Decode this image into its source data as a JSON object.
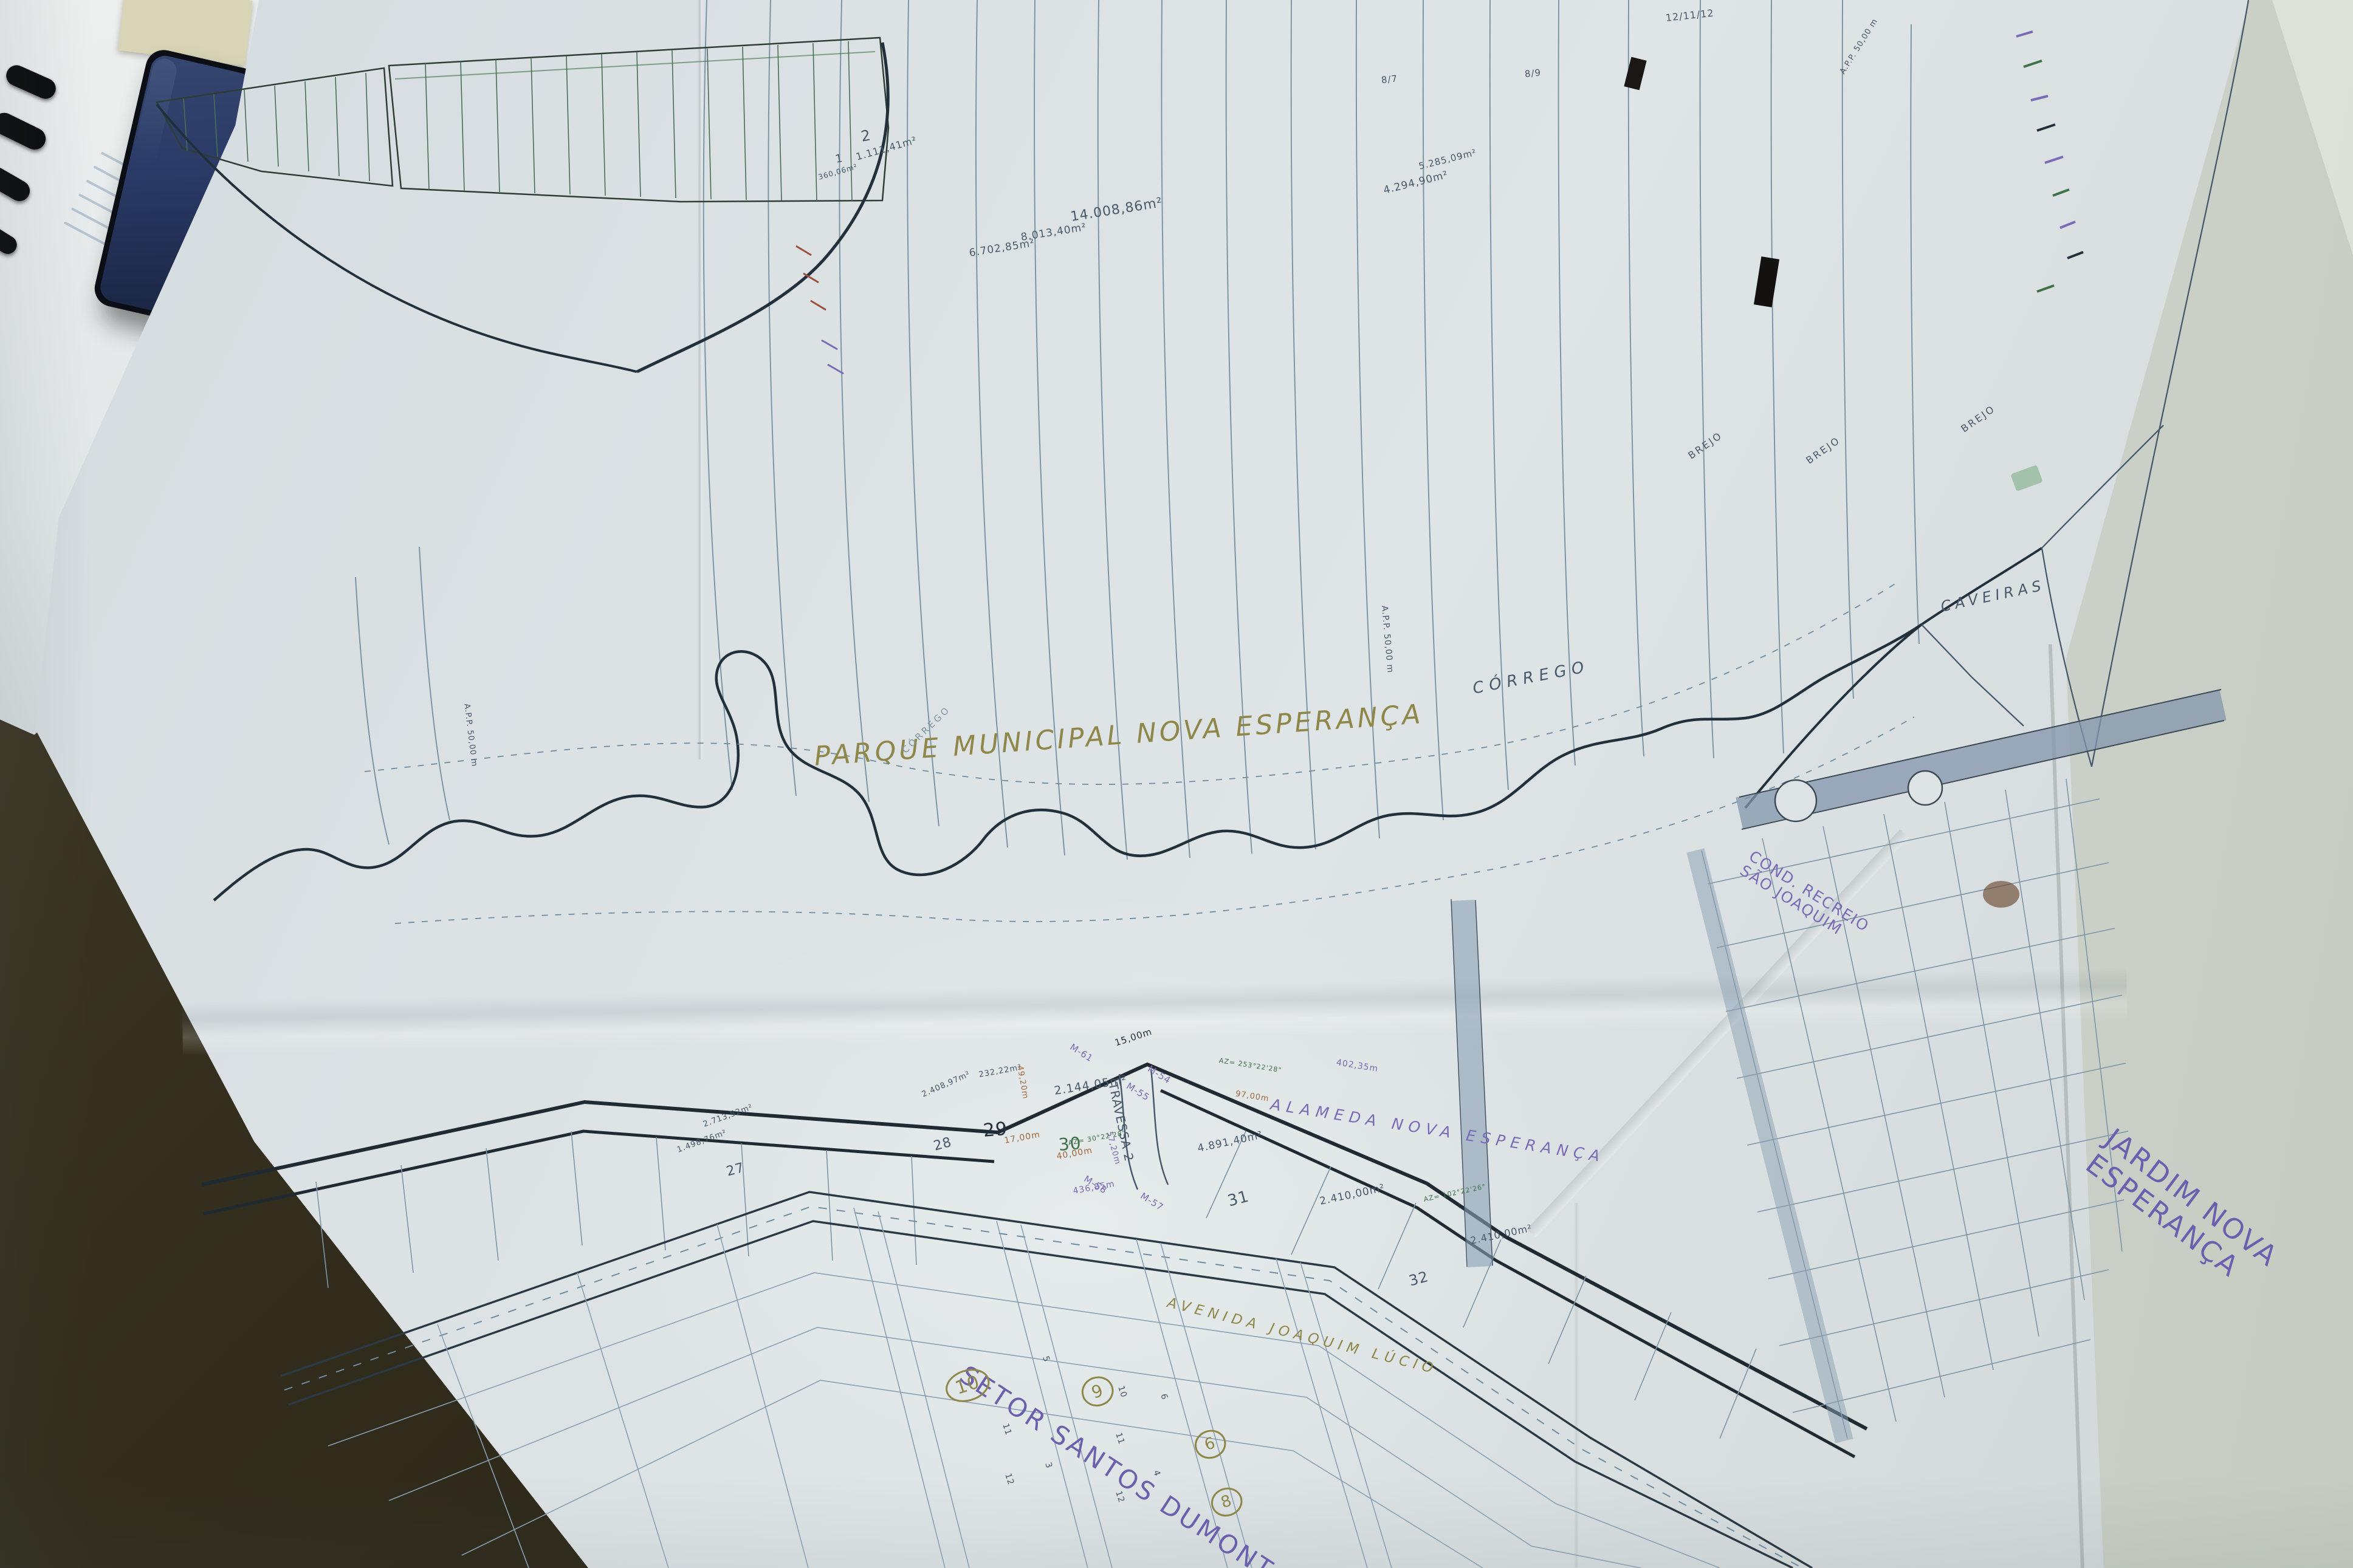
{
  "scene": {
    "type": "photograph of a folded cadastral street map lying on a desk",
    "objects": [
      "smartphone",
      "binder-rings",
      "cream-folder",
      "document-stack",
      "map-sheet",
      "folded-companion-sheet",
      "desk-surface",
      "black-tape-marks"
    ]
  },
  "palette": {
    "ink": "#47596b",
    "inkDark": "#22303c",
    "inkLight": "#7e95a6",
    "green": "#3f7249",
    "purple": "#7b6ab8",
    "violet": "#6c5fae",
    "olive": "#8f874a",
    "orange": "#a06a3c",
    "blueRoad": "#8296ac",
    "phoneScreen": "#2a3a66",
    "paper": "#dce2e4",
    "desk": "#332e1d"
  },
  "map": {
    "park_title": "PARQUE MUNICIPAL NOVA ESPERANÇA",
    "sector_title": "SETOR SANTOS DUMONT",
    "adjacent_panel_title": "JARDIM NOVA ESPERANÇA",
    "watercourse": [
      "CÓRREGO",
      "CAVEIRAS"
    ],
    "streets": [
      "ALAMEDA NOVA ESPERANÇA",
      "AVENIDA JOAQUIM LÚCIO",
      "TRAVESSA 2"
    ],
    "condominium": "COND. RECREIO SÃO JOAQUIM",
    "protection_strip": "A.P.P. 50,00 m",
    "wetland": "BREJO",
    "labels": [
      {
        "name": "park-title",
        "text": "PARQUE MUNICIPAL NOVA ESPERANÇA",
        "x": 34.6,
        "y": 47.3,
        "rot": -4,
        "size": 44,
        "color": "olive",
        "spacing": 5,
        "italic": true
      },
      {
        "name": "sector-title",
        "text": "SETOR SANTOS DUMONT",
        "x": 40.9,
        "y": 86.6,
        "rot": 33,
        "size": 42,
        "color": "violet",
        "spacing": 4
      },
      {
        "name": "jardim-panel-title",
        "text": "JARDIM NOVA\nESPERANÇA",
        "x": 89.2,
        "y": 71.2,
        "rot": 37,
        "size": 46,
        "color": "violet",
        "spacing": 3
      },
      {
        "name": "corrego-label",
        "text": "CÓRREGO",
        "x": 62.6,
        "y": 43.4,
        "rot": -11,
        "size": 26,
        "color": "ink",
        "spacing": 9,
        "italic": true
      },
      {
        "name": "caveiras-label",
        "text": "CAVEIRAS",
        "x": 82.5,
        "y": 38.2,
        "rot": -12,
        "size": 24,
        "color": "ink",
        "spacing": 7,
        "italic": true
      },
      {
        "name": "corrego-small-label",
        "text": "CÓRREGO",
        "x": 38.4,
        "y": 47.6,
        "rot": -44,
        "size": 15,
        "color": "inkLight",
        "spacing": 4
      },
      {
        "name": "cond-recreio-label",
        "text": "COND. RECREIO\nSÃO JOAQUIM",
        "x": 74.2,
        "y": 53.9,
        "rot": 32,
        "size": 25,
        "color": "purple",
        "spacing": 2
      },
      {
        "name": "alameda-label",
        "text": "ALAMEDA  NOVA  ESPERANÇA",
        "x": 54.0,
        "y": 69.9,
        "rot": 9,
        "size": 25,
        "color": "purple",
        "spacing": 9,
        "italic": true
      },
      {
        "name": "avenida-label",
        "text": "AVENIDA  JOAQUIM  LÚCIO",
        "x": 49.6,
        "y": 82.6,
        "rot": 14,
        "size": 23,
        "color": "olive",
        "spacing": 8,
        "italic": true
      },
      {
        "name": "travessa-label",
        "text": "TRAVESSA 2",
        "x": 47.3,
        "y": 68.6,
        "rot": 78,
        "size": 20,
        "color": "ink"
      },
      {
        "name": "brejo-label-1",
        "text": "BREJO",
        "x": 71.8,
        "y": 28.8,
        "rot": -35,
        "size": 16,
        "color": "ink",
        "spacing": 3
      },
      {
        "name": "brejo-label-2",
        "text": "BREJO",
        "x": 76.8,
        "y": 29.1,
        "rot": -35,
        "size": 16,
        "color": "ink",
        "spacing": 3
      },
      {
        "name": "brejo-label-3",
        "text": "BREJO",
        "x": 83.4,
        "y": 27.1,
        "rot": -35,
        "size": 16,
        "color": "ink",
        "spacing": 3
      },
      {
        "name": "app-label-1",
        "text": "A.P.P. 50,00 m",
        "x": 19.8,
        "y": 44.6,
        "rot": 83,
        "size": 13,
        "color": "ink"
      },
      {
        "name": "app-label-2",
        "text": "A.P.P. 50,00 m",
        "x": 58.8,
        "y": 38.3,
        "rot": 85,
        "size": 14,
        "color": "ink"
      },
      {
        "name": "app-label-3",
        "text": "A.P.P. 50,00 m",
        "x": 78.3,
        "y": 4.4,
        "rot": -58,
        "size": 13,
        "color": "ink"
      },
      {
        "name": "area-14008",
        "text": "14.008,86m²",
        "x": 45.5,
        "y": 13.4,
        "rot": -9,
        "size": 22,
        "color": "ink"
      },
      {
        "name": "area-8013",
        "text": "8.013,40m²",
        "x": 43.4,
        "y": 14.8,
        "rot": -9,
        "size": 17,
        "color": "ink"
      },
      {
        "name": "area-6702",
        "text": "6.702,85m²",
        "x": 41.2,
        "y": 15.8,
        "rot": -9,
        "size": 17,
        "color": "ink"
      },
      {
        "name": "area-4294",
        "text": "4.294,90m²",
        "x": 58.8,
        "y": 11.8,
        "rot": -14,
        "size": 17,
        "color": "ink"
      },
      {
        "name": "area-5285",
        "text": "5.285,09m²",
        "x": 60.3,
        "y": 10.3,
        "rot": -14,
        "size": 15,
        "color": "ink"
      },
      {
        "name": "area-1111",
        "text": "1.111,41m²",
        "x": 36.4,
        "y": 9.7,
        "rot": -16,
        "size": 16,
        "color": "ink"
      },
      {
        "name": "area-360",
        "text": "360,06m²",
        "x": 34.8,
        "y": 11.1,
        "rot": -16,
        "size": 12,
        "color": "ink"
      },
      {
        "name": "area-2144",
        "text": "2.144,05m²",
        "x": 44.8,
        "y": 69.2,
        "rot": -9,
        "size": 19,
        "color": "ink"
      },
      {
        "name": "area-4891",
        "text": "4.891,40m²",
        "x": 50.9,
        "y": 72.9,
        "rot": -12,
        "size": 17,
        "color": "ink"
      },
      {
        "name": "area-2410-a",
        "text": "2.410,00m²",
        "x": 56.1,
        "y": 76.3,
        "rot": -12,
        "size": 17,
        "color": "ink"
      },
      {
        "name": "area-2410-b",
        "text": "2.410,00m²",
        "x": 62.5,
        "y": 78.8,
        "rot": -12,
        "size": 16,
        "color": "ink"
      },
      {
        "name": "area-232",
        "text": "232,22m²",
        "x": 41.6,
        "y": 68.3,
        "rot": -10,
        "size": 13,
        "color": "ink"
      },
      {
        "name": "area-2408",
        "text": "2.408,97m²",
        "x": 39.2,
        "y": 69.6,
        "rot": -24,
        "size": 13,
        "color": "ink"
      },
      {
        "name": "area-1498",
        "text": "1.498,76m²",
        "x": 28.8,
        "y": 73.1,
        "rot": -20,
        "size": 13,
        "color": "ink"
      },
      {
        "name": "area-2713",
        "text": "2.713,52m²",
        "x": 29.9,
        "y": 71.5,
        "rot": -20,
        "size": 13,
        "color": "ink"
      },
      {
        "name": "quadra-29",
        "text": "29",
        "x": 41.8,
        "y": 71.5,
        "rot": -5,
        "size": 30,
        "color": "inkDark"
      },
      {
        "name": "quadra-30",
        "text": "30",
        "x": 45.0,
        "y": 72.4,
        "rot": -5,
        "size": 28,
        "color": "green"
      },
      {
        "name": "quadra-28",
        "text": "28",
        "x": 39.7,
        "y": 72.7,
        "rot": -15,
        "size": 22,
        "color": "ink"
      },
      {
        "name": "quadra-31",
        "text": "31",
        "x": 52.2,
        "y": 76.1,
        "rot": -15,
        "size": 26,
        "color": "ink"
      },
      {
        "name": "quadra-32",
        "text": "32",
        "x": 59.9,
        "y": 81.2,
        "rot": -15,
        "size": 24,
        "color": "ink"
      },
      {
        "name": "quadra-27",
        "text": "27",
        "x": 30.9,
        "y": 74.3,
        "rot": -15,
        "size": 22,
        "color": "ink"
      },
      {
        "name": "quadra-2",
        "text": "2",
        "x": 36.6,
        "y": 8.2,
        "rot": -10,
        "size": 24,
        "color": "ink"
      },
      {
        "name": "quadra-1",
        "text": "1",
        "x": 35.5,
        "y": 9.8,
        "rot": -10,
        "size": 18,
        "color": "ink"
      },
      {
        "name": "circle-block-10",
        "text": "10",
        "x": 40.2,
        "y": 87.8,
        "rot": -18,
        "size": 30,
        "color": "olive",
        "circled": true
      },
      {
        "name": "circle-block-9",
        "text": "9",
        "x": 46.0,
        "y": 88.1,
        "rot": -18,
        "size": 28,
        "color": "olive",
        "circled": true
      },
      {
        "name": "circle-block-6",
        "text": "6",
        "x": 50.8,
        "y": 91.5,
        "rot": -18,
        "size": 26,
        "color": "olive",
        "circled": true
      },
      {
        "name": "circle-block-8",
        "text": "8",
        "x": 51.5,
        "y": 95.2,
        "rot": -18,
        "size": 26,
        "color": "olive",
        "circled": true
      },
      {
        "name": "lot-5",
        "text": "5",
        "x": 44.4,
        "y": 86.2,
        "rot": 72,
        "size": 14,
        "color": "ink"
      },
      {
        "name": "lot-10",
        "text": "10",
        "x": 47.6,
        "y": 88.1,
        "rot": 72,
        "size": 14,
        "color": "ink"
      },
      {
        "name": "lot-11a",
        "text": "11",
        "x": 47.5,
        "y": 91.1,
        "rot": 72,
        "size": 14,
        "color": "ink"
      },
      {
        "name": "lot-12a",
        "text": "12",
        "x": 47.5,
        "y": 94.8,
        "rot": 72,
        "size": 14,
        "color": "ink"
      },
      {
        "name": "lot-11b",
        "text": "11",
        "x": 42.7,
        "y": 90.5,
        "rot": 72,
        "size": 14,
        "color": "ink"
      },
      {
        "name": "lot-12b",
        "text": "12",
        "x": 42.8,
        "y": 93.7,
        "rot": 72,
        "size": 14,
        "color": "ink"
      },
      {
        "name": "lot-3",
        "text": "3",
        "x": 44.5,
        "y": 93.0,
        "rot": 72,
        "size": 14,
        "color": "ink"
      },
      {
        "name": "lot-6",
        "text": "6",
        "x": 49.4,
        "y": 88.6,
        "rot": 72,
        "size": 14,
        "color": "ink"
      },
      {
        "name": "lot-4",
        "text": "4",
        "x": 49.1,
        "y": 93.5,
        "rot": 72,
        "size": 14,
        "color": "ink"
      },
      {
        "name": "marker-m54",
        "text": "M-54",
        "x": 48.8,
        "y": 67.8,
        "rot": 32,
        "size": 15,
        "color": "purple"
      },
      {
        "name": "marker-m55",
        "text": "M-55",
        "x": 47.9,
        "y": 68.9,
        "rot": 32,
        "size": 15,
        "color": "purple"
      },
      {
        "name": "marker-m61",
        "text": "M-61",
        "x": 45.5,
        "y": 66.4,
        "rot": 32,
        "size": 15,
        "color": "purple"
      },
      {
        "name": "marker-m57",
        "text": "M-57",
        "x": 48.5,
        "y": 75.9,
        "rot": 32,
        "size": 15,
        "color": "purple"
      },
      {
        "name": "marker-m58",
        "text": "M-58",
        "x": 46.1,
        "y": 74.8,
        "rot": 32,
        "size": 15,
        "color": "purple"
      },
      {
        "name": "meas-15m",
        "text": "15,00m",
        "x": 47.4,
        "y": 66.2,
        "rot": -18,
        "size": 15,
        "color": "inkDark"
      },
      {
        "name": "meas-17m",
        "text": "17,00m",
        "x": 42.7,
        "y": 72.5,
        "rot": -10,
        "size": 14,
        "color": "orange"
      },
      {
        "name": "meas-40m",
        "text": "40,00m",
        "x": 44.9,
        "y": 73.5,
        "rot": -10,
        "size": 14,
        "color": "orange"
      },
      {
        "name": "meas-436m",
        "text": "436,85m",
        "x": 45.6,
        "y": 75.7,
        "rot": -10,
        "size": 14,
        "color": "purple"
      },
      {
        "name": "meas-57m",
        "text": "57,20m",
        "x": 47.1,
        "y": 71.9,
        "rot": 75,
        "size": 13,
        "color": "purple"
      },
      {
        "name": "meas-49m",
        "text": "49,20m",
        "x": 43.3,
        "y": 67.7,
        "rot": 80,
        "size": 13,
        "color": "orange"
      },
      {
        "name": "meas-402m",
        "text": "402,35m",
        "x": 56.8,
        "y": 67.5,
        "rot": 9,
        "size": 14,
        "color": "purple"
      },
      {
        "name": "meas-97m",
        "text": "97,00m",
        "x": 52.5,
        "y": 69.5,
        "rot": 9,
        "size": 13,
        "color": "orange"
      },
      {
        "name": "azimuth-1",
        "text": "AZ= 30°22'28\"",
        "x": 45.4,
        "y": 72.7,
        "rot": -10,
        "size": 11,
        "color": "green"
      },
      {
        "name": "azimuth-2",
        "text": "AZ= 253°22'28\"",
        "x": 51.8,
        "y": 67.4,
        "rot": 9,
        "size": 11,
        "color": "green"
      },
      {
        "name": "azimuth-3",
        "text": "AZ= 102°22'26\"",
        "x": 60.5,
        "y": 76.3,
        "rot": -12,
        "size": 11,
        "color": "green"
      },
      {
        "name": "date-note",
        "text": "12/11/12",
        "x": 70.8,
        "y": 0.8,
        "rot": -6,
        "size": 16,
        "color": "ink"
      },
      {
        "name": "ref-8-7",
        "text": "8/7",
        "x": 58.7,
        "y": 4.8,
        "rot": -6,
        "size": 15,
        "color": "ink"
      },
      {
        "name": "ref-8-9",
        "text": "8/9",
        "x": 64.8,
        "y": 4.4,
        "rot": -6,
        "size": 15,
        "color": "ink"
      }
    ]
  }
}
